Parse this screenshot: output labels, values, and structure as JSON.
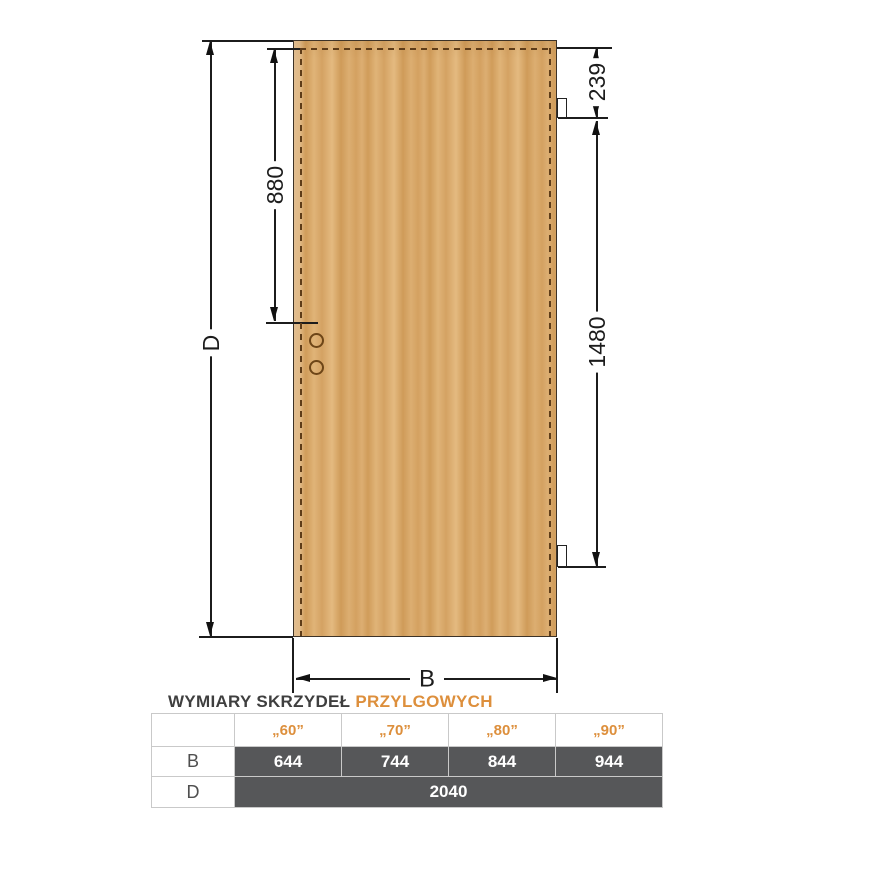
{
  "diagram": {
    "height_label": "D",
    "width_label": "B",
    "handle_dim": "880",
    "top_hinge_dim": "239",
    "hinge_spacing_dim": "1480"
  },
  "caption": {
    "part_dark": "WYMIARY SKRZYDEŁ",
    "part_orange": "PRZYLGOWYCH"
  },
  "table": {
    "col_headers": [
      "„60”",
      "„70”",
      "„80”",
      "„90”"
    ],
    "row_b": {
      "label": "B",
      "values": [
        "644",
        "744",
        "844",
        "944"
      ]
    },
    "row_d": {
      "label": "D",
      "value": "2040"
    }
  },
  "colors": {
    "accent_orange": "#dd8f3c",
    "dark_cell": "#565759",
    "caption_dark": "#3f3f3f",
    "wood_base": "#d8a768",
    "rebate_dash_brown": "#5e3c18",
    "dimension_line": "#1c1c1c"
  }
}
